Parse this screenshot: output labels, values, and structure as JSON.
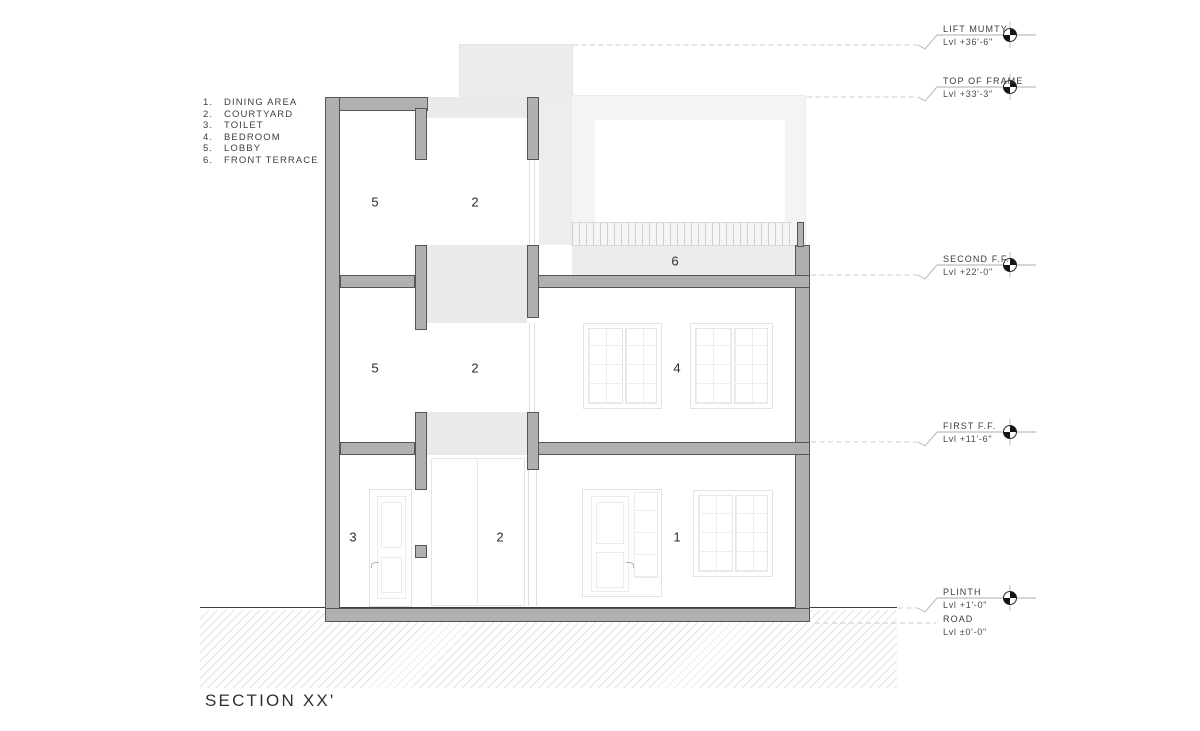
{
  "title": "SECTION XX'",
  "legend": {
    "items": [
      {
        "num": "1.",
        "label": "DINING AREA"
      },
      {
        "num": "2.",
        "label": "COURTYARD"
      },
      {
        "num": "3.",
        "label": "TOILET"
      },
      {
        "num": "4.",
        "label": "BEDROOM"
      },
      {
        "num": "5.",
        "label": "LOBBY"
      },
      {
        "num": "6.",
        "label": "FRONT TERRACE"
      }
    ]
  },
  "levels": [
    {
      "name": "LIFT MUMTY",
      "value": "Lvl +36'-6\""
    },
    {
      "name": "TOP OF FRAME",
      "value": "Lvl +33'-3\""
    },
    {
      "name": "SECOND F.F.",
      "value": "Lvl +22'-0\""
    },
    {
      "name": "FIRST F.F.",
      "value": "Lvl +11'-6\""
    },
    {
      "name": "PLINTH",
      "value": "Lvl +1'-0\""
    },
    {
      "name": "ROAD",
      "value": "Lvl ±0'-0\""
    }
  ],
  "room_labels": {
    "lobby_upper": "5",
    "courtyard_upper": "2",
    "front_terrace": "6",
    "lobby_lower": "5",
    "courtyard_mid": "2",
    "bedroom": "4",
    "toilet": "3",
    "courtyard_ground": "2",
    "dining": "1"
  },
  "colors": {
    "cut_fill": "#b0b0b0",
    "cut_outline": "#565656",
    "light_fill": "#ededed",
    "leader": "#cfcfcf",
    "ground_line": "#3f3f3f",
    "marker_black": "#141414"
  }
}
